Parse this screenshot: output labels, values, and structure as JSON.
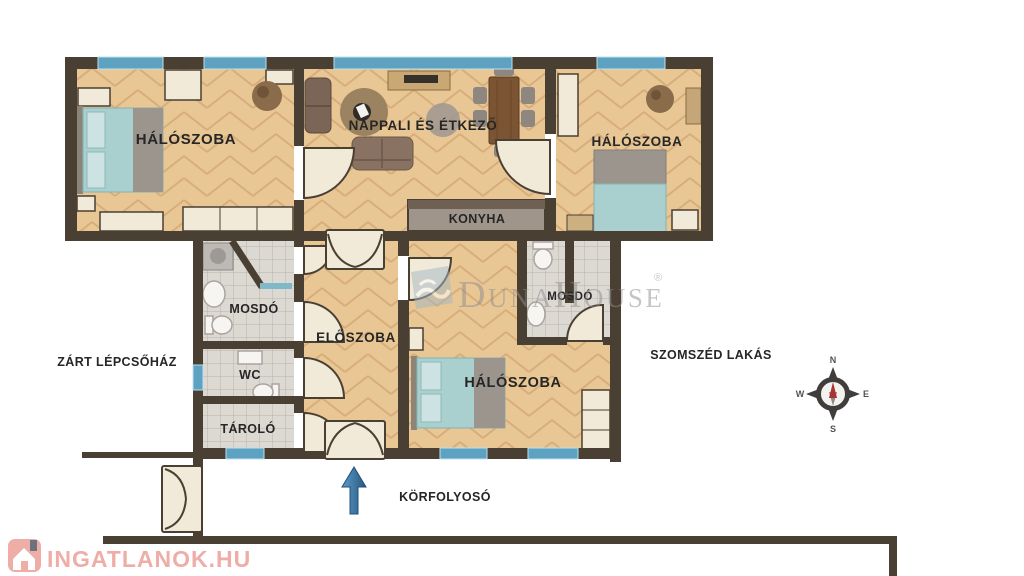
{
  "rooms": {
    "bedroom_left": "HÁLÓSZOBA",
    "living_dining": "NAPPALI ÉS ÉTKEZŐ",
    "bedroom_right": "HÁLÓSZOBA",
    "kitchen": "KONYHA",
    "washroom_left": "MOSDÓ",
    "hall": "ELŐSZOBA",
    "wc": "WC",
    "storage": "TÁROLÓ",
    "bedroom_bottom": "HÁLÓSZOBA",
    "washroom_right": "MOSDÓ"
  },
  "outside": {
    "stairwell": "ZÁRT LÉPCSŐHÁZ",
    "neighbor": "SZOMSZÉD LAKÁS",
    "corridor": "KÖRFOLYOSÓ"
  },
  "compass": {
    "north": "N",
    "east": "E",
    "south": "S",
    "west": "W"
  },
  "watermarks": {
    "portal": "INGATLANOK.HU",
    "agency_parts": [
      "D",
      "UNA",
      "H",
      "OUSE"
    ],
    "registered": "®"
  },
  "colors": {
    "wall": "#4a3f33",
    "floor_wood": "#e9c795",
    "floor_wood_line": "#d7ad7b",
    "floor_tile": "#dcd8d2",
    "window_blue": "#5ea2c2",
    "door_cream": "#f2ead9",
    "bed_teal": "#a9cfcf",
    "label_text": "#262626",
    "portal_pink": "#eda59e",
    "watermark_gray": "#8d8d8d",
    "arrow_blue": "#2f6b9b"
  }
}
